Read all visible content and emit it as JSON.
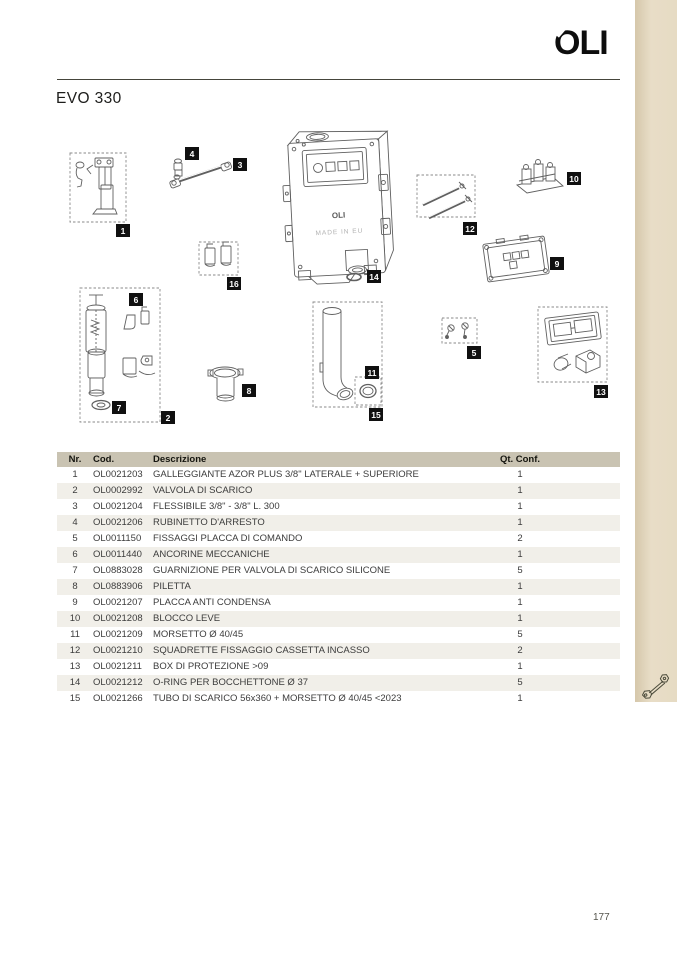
{
  "page": {
    "brand": "OLI",
    "title": "EVO 330",
    "page_number": "177"
  },
  "header": {
    "logo_icon": "oli-brand-logo"
  },
  "stripe": {
    "icon": "wrench-icon",
    "color": "#e6dbc3"
  },
  "diagram": {
    "tank_brand": "OLI",
    "tank_note": "MADE IN EU",
    "labels": [
      "1",
      "2",
      "3",
      "4",
      "5",
      "6",
      "7",
      "8",
      "9",
      "10",
      "11",
      "12",
      "13",
      "14",
      "15",
      "16"
    ]
  },
  "table": {
    "headers": [
      "Nr.",
      "Cod.",
      "Descrizione",
      "Qt. Conf."
    ],
    "rows": [
      {
        "nr": "1",
        "cod": "OL0021203",
        "desc": "GALLEGGIANTE AZOR PLUS 3/8\" LATERALE + SUPERIORE",
        "qt": "1"
      },
      {
        "nr": "2",
        "cod": "OL0002992",
        "desc": "VALVOLA DI SCARICO",
        "qt": "1"
      },
      {
        "nr": "3",
        "cod": "OL0021204",
        "desc": "FLESSIBILE 3/8\" - 3/8\" L. 300",
        "qt": "1"
      },
      {
        "nr": "4",
        "cod": "OL0021206",
        "desc": "RUBINETTO D'ARRESTO",
        "qt": "1"
      },
      {
        "nr": "5",
        "cod": "OL0011150",
        "desc": "FISSAGGI PLACCA DI COMANDO",
        "qt": "2"
      },
      {
        "nr": "6",
        "cod": "OL0011440",
        "desc": "ANCORINE MECCANICHE",
        "qt": "1"
      },
      {
        "nr": "7",
        "cod": "OL0883028",
        "desc": "GUARNIZIONE PER VALVOLA DI SCARICO SILICONE",
        "qt": "5"
      },
      {
        "nr": "8",
        "cod": "OL0883906",
        "desc": "PILETTA",
        "qt": "1"
      },
      {
        "nr": "9",
        "cod": "OL0021207",
        "desc": "PLACCA ANTI CONDENSA",
        "qt": "1"
      },
      {
        "nr": "10",
        "cod": "OL0021208",
        "desc": "BLOCCO LEVE",
        "qt": "1"
      },
      {
        "nr": "11",
        "cod": "OL0021209",
        "desc": "MORSETTO Ø 40/45",
        "qt": "5"
      },
      {
        "nr": "12",
        "cod": "OL0021210",
        "desc": "SQUADRETTE FISSAGGIO CASSETTA INCASSO",
        "qt": "2"
      },
      {
        "nr": "13",
        "cod": "OL0021211",
        "desc": "BOX DI PROTEZIONE >09",
        "qt": "1"
      },
      {
        "nr": "14",
        "cod": "OL0021212",
        "desc": "O-RING PER BOCCHETTONE Ø 37",
        "qt": "5"
      },
      {
        "nr": "15",
        "cod": "OL0021266",
        "desc": "TUBO DI SCARICO 56x360 + MORSETTO Ø 40/45 <2023",
        "qt": "1"
      }
    ]
  },
  "colors": {
    "stripe": "#e6dbc3",
    "table_header_bg": "#c9c3b2",
    "row_alt_bg": "#f1efe9",
    "label_bg": "#101010",
    "line_art": "#606060"
  }
}
